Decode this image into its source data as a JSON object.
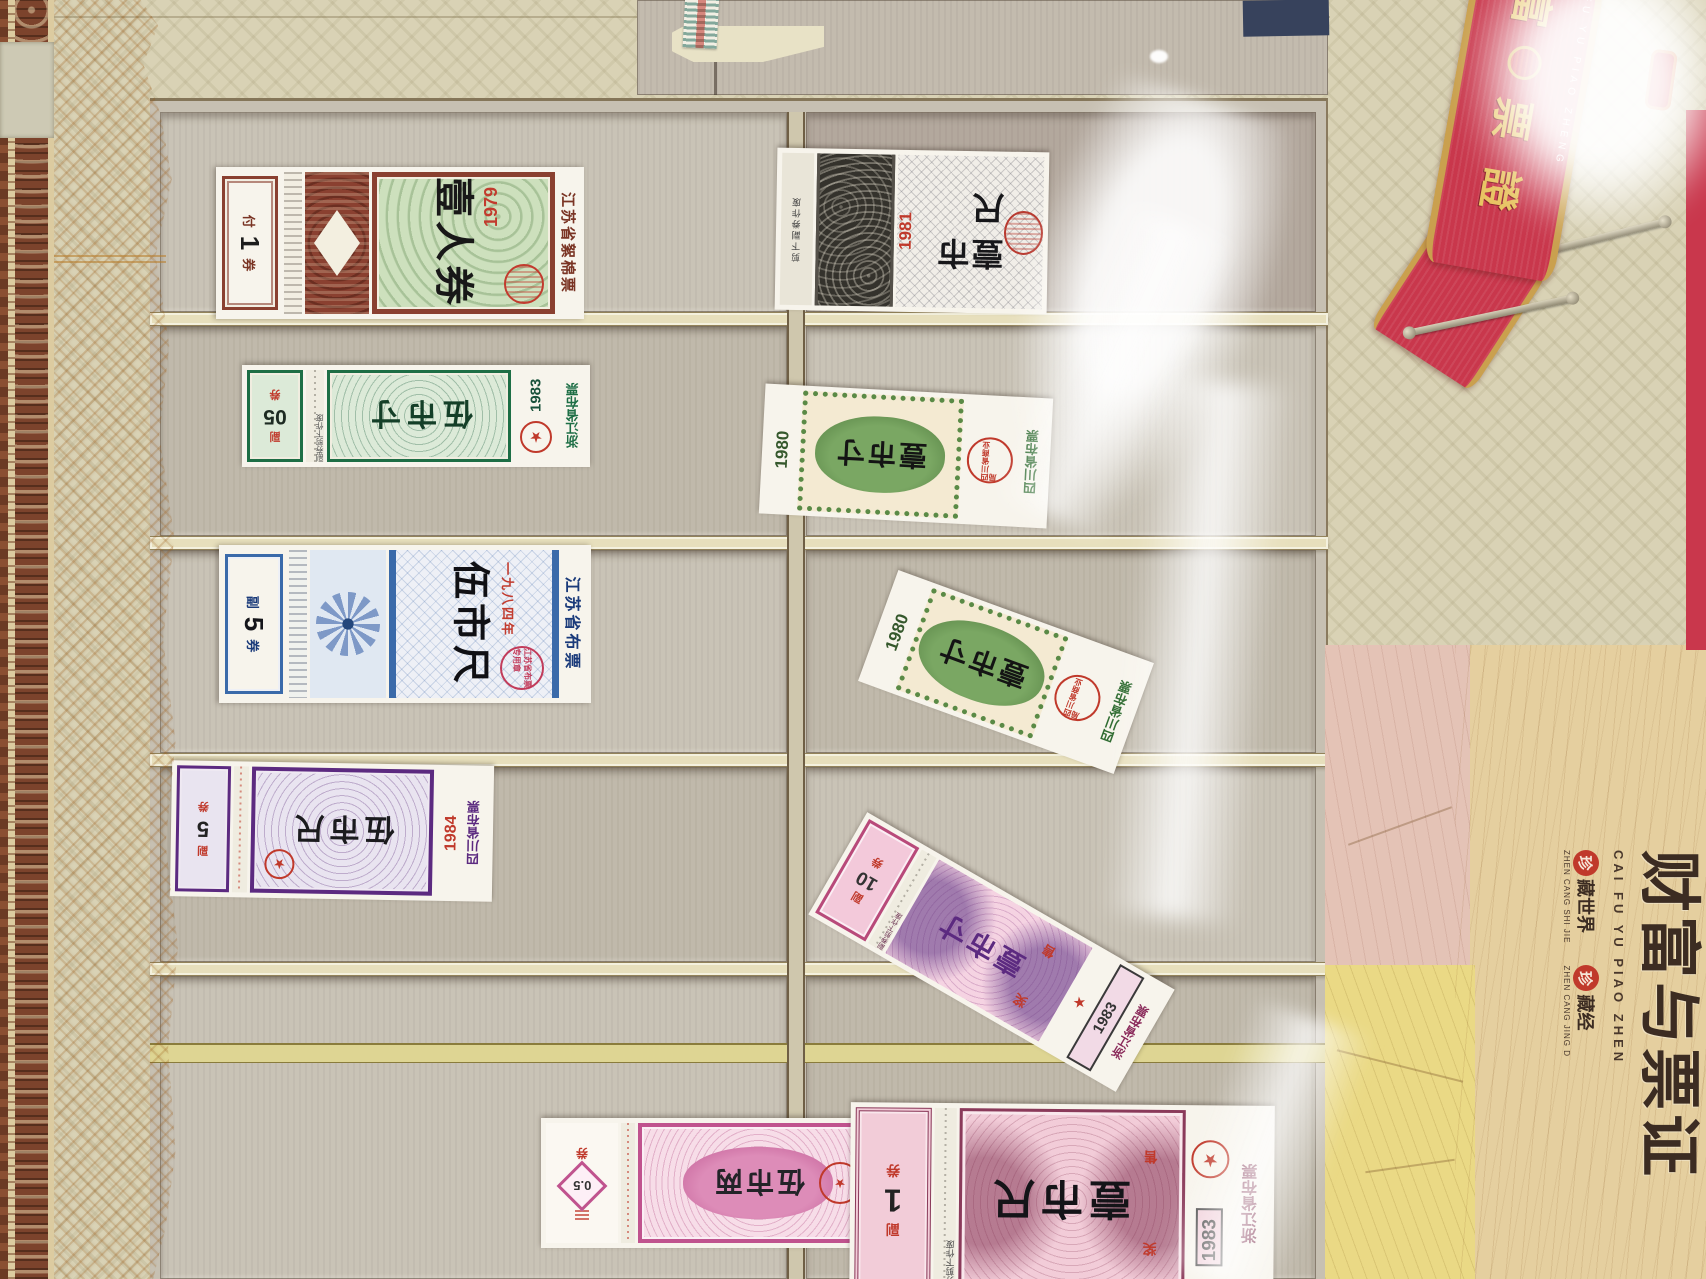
{
  "cover": {
    "banner": {
      "char_top": "富",
      "char_2": "票",
      "char_3": "證",
      "latin": "FU YU PIAO ZHENG"
    },
    "title_cn": "财富与票证",
    "title_latin": "CAI FU YU PIAO ZHEN",
    "collect": [
      {
        "seal_char": "珍",
        "cn": "藏世界",
        "latin": "ZHEN CANG SHI JIE"
      },
      {
        "seal_char": "珍",
        "cn": "藏经",
        "latin": "ZHEN CANG JING D"
      }
    ]
  },
  "coupons": [
    {
      "id": "jiangsu-cotton-1979",
      "issuer": "江苏省絮棉票",
      "year": "1979",
      "denomination": "壹人券",
      "stub_prefix": "付",
      "stub_value": "1",
      "stub_suffix": "券"
    },
    {
      "id": "gray-1981",
      "year": "1981",
      "denomination": "壹市尺",
      "note": "剪下副券作废"
    },
    {
      "id": "zhejiang-1983-5cun",
      "issuer": "浙江省布票",
      "year": "1983",
      "denomination": "伍市寸",
      "stub_prefix": "副",
      "stub_value": "05",
      "stub_suffix": "券",
      "note": "副券剪下作废"
    },
    {
      "id": "sichuan-1980-a",
      "issuer": "四川省布票",
      "year": "1980",
      "denomination": "壹市寸",
      "seal": "四川省商业局"
    },
    {
      "id": "jiangsu-1984-5chi",
      "issuer": "江苏省布票",
      "year_text": "一九八四年",
      "denomination": "伍市尺",
      "seal": "江苏省布票专用章",
      "stub_prefix": "副",
      "stub_value": "5",
      "stub_suffix": "券"
    },
    {
      "id": "sichuan-1980-b",
      "issuer": "四川省布票",
      "year": "1980",
      "denomination": "壹市寸",
      "seal": "四川省商业局"
    },
    {
      "id": "sichuan-1984-5chi",
      "issuer": "四川省布票",
      "year": "1984",
      "denomination": "伍市尺",
      "stub_prefix": "副",
      "stub_value": "5",
      "stub_suffix": "券"
    },
    {
      "id": "zhejiang-1983-1cun",
      "issuer": "浙江省布票",
      "year": "1983",
      "denomination": "壹市寸",
      "extra_top": "奖",
      "extra_bottom": "售",
      "stub_prefix": "副",
      "stub_value": "10",
      "stub_suffix": "券",
      "note": "副券剪下作废"
    },
    {
      "id": "sichuan-1984-5liang",
      "issuer": "四川省棉花票",
      "year": "1984",
      "denomination": "伍市两",
      "stub_value": "0.5",
      "stub_suffix": "券"
    },
    {
      "id": "zhejiang-1983-1chi",
      "issuer": "浙江省布票",
      "year": "1983",
      "denomination": "壹市尺",
      "extra_top": "奖",
      "extra_bottom": "售",
      "stub_prefix": "副",
      "stub_value": "1",
      "stub_suffix": "券",
      "note": "副券剪下作废"
    }
  ],
  "stars": {
    "glyph": "★"
  }
}
